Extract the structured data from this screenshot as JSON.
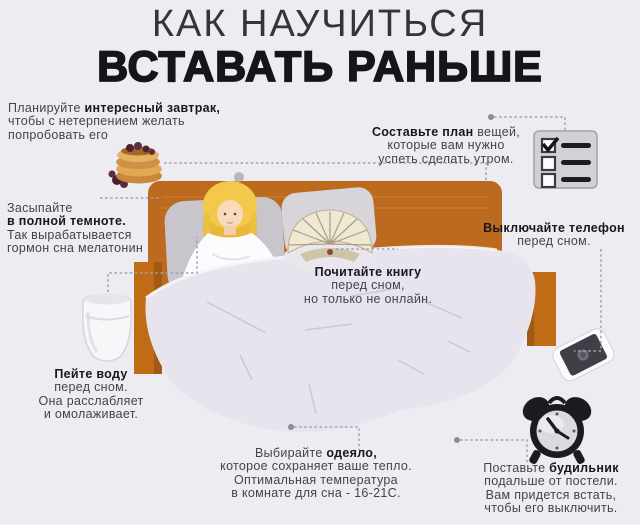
{
  "title": {
    "line1": "КАК НАУЧИТЬСЯ",
    "line2": "ВСТАВАТЬ РАНЬШЕ"
  },
  "tips": {
    "breakfast": {
      "before": "Планируйте ",
      "bold": "интересный завтрак,",
      "after": "\nчтобы с нетерпением желать\nпопробовать его"
    },
    "plan": {
      "before": "",
      "bold": "Составьте план",
      "after": " вещей,\nкоторые вам нужно\nуспеть сделать утром."
    },
    "darkness": {
      "before": "Засыпайте\n",
      "bold": "в полной темноте.",
      "after": "\nТак вырабатывается\nгормон сна мелатонин"
    },
    "book": {
      "before": "",
      "bold": "Почитайте книгу",
      "after": "\nперед сном,\nно только не онлайн."
    },
    "phone": {
      "before": "",
      "bold": "Выключайте телефон",
      "after": "\nперед сном."
    },
    "water": {
      "before": "",
      "bold": "Пейте воду",
      "after": "\nперед сном.\nОна расслабляет\nи омолаживает."
    },
    "blanket": {
      "before": "Выбирайте ",
      "bold": "одеяло,",
      "after": "\nкоторое сохраняет ваше тепло.\nОптимальная температура\nв комнате для сна - 16-21C."
    },
    "alarm": {
      "before": "Поставьте ",
      "bold": "будильник",
      "after": "\nподальше от постели.\nВам придется встать,\nчтобы его выключить."
    }
  },
  "icons": {
    "breakfast": "pancakes-icon",
    "plan": "checklist-icon",
    "water": "water-glass-icon",
    "book": "open-book-icon",
    "phone": "smartphone-icon",
    "alarm": "alarm-clock-icon"
  },
  "colors": {
    "background": "#edecf3",
    "headboard": "#bc6a1d",
    "blanket": "#e7e4ed",
    "pillow": "#c9c7cd",
    "hair": "#f3c94c",
    "text": "#44434b",
    "text_bold": "#17171d",
    "connector": "#a3a0ab"
  }
}
